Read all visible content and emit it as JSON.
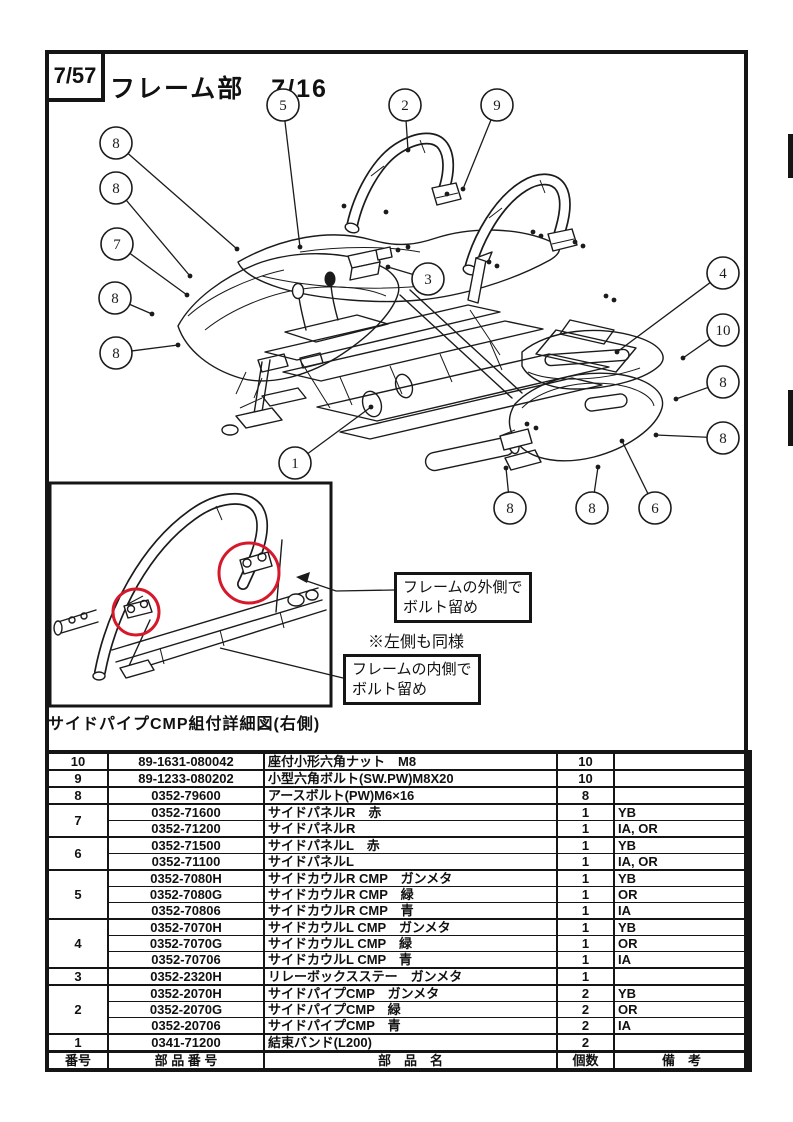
{
  "page": {
    "page_ref": "7/57",
    "title": "フレーム部　7/16"
  },
  "diagram": {
    "inset": {
      "caption": "サイドパイプCMP組付詳細図(右側)",
      "outside_label": [
        "フレームの外側で",
        "ボルト留め"
      ],
      "note": "※左側も同様",
      "inside_label": [
        "フレームの内側で",
        "ボルト留め"
      ],
      "highlight_color": "#d6182b"
    },
    "balloons": [
      {
        "n": "8",
        "x": 116,
        "y": 143,
        "tx": 237,
        "ty": 249
      },
      {
        "n": "8",
        "x": 116,
        "y": 188,
        "tx": 190,
        "ty": 276
      },
      {
        "n": "7",
        "x": 117,
        "y": 244,
        "tx": 187,
        "ty": 295
      },
      {
        "n": "8",
        "x": 115,
        "y": 298,
        "tx": 152,
        "ty": 314
      },
      {
        "n": "8",
        "x": 116,
        "y": 353,
        "tx": 178,
        "ty": 345
      },
      {
        "n": "5",
        "x": 283,
        "y": 105,
        "tx": 300,
        "ty": 247
      },
      {
        "n": "2",
        "x": 405,
        "y": 105,
        "tx": 408,
        "ty": 150
      },
      {
        "n": "9",
        "x": 497,
        "y": 105,
        "tx": 463,
        "ty": 189
      },
      {
        "n": "3",
        "x": 428,
        "y": 279,
        "tx": 388,
        "ty": 267
      },
      {
        "n": "1",
        "x": 295,
        "y": 463,
        "tx": 371,
        "ty": 407
      },
      {
        "n": "4",
        "x": 723,
        "y": 273,
        "tx": 617,
        "ty": 352
      },
      {
        "n": "10",
        "x": 723,
        "y": 330,
        "tx": 683,
        "ty": 358
      },
      {
        "n": "8",
        "x": 723,
        "y": 382,
        "tx": 676,
        "ty": 399
      },
      {
        "n": "8",
        "x": 723,
        "y": 438,
        "tx": 656,
        "ty": 435
      },
      {
        "n": "8",
        "x": 510,
        "y": 508,
        "tx": 506,
        "ty": 468
      },
      {
        "n": "8",
        "x": 592,
        "y": 508,
        "tx": 598,
        "ty": 467
      },
      {
        "n": "6",
        "x": 655,
        "y": 508,
        "tx": 622,
        "ty": 441
      }
    ]
  },
  "table": {
    "header": [
      "番号",
      "部 品 番 号",
      "部　品　名",
      "個数",
      "備　考"
    ],
    "groups": [
      {
        "no": "10",
        "rows": [
          [
            "89-1631-080042",
            "座付小形六角ナット　M8",
            "10",
            ""
          ]
        ]
      },
      {
        "no": "9",
        "rows": [
          [
            "89-1233-080202",
            "小型六角ボルト(SW.PW)M8X20",
            "10",
            ""
          ]
        ]
      },
      {
        "no": "8",
        "rows": [
          [
            "0352-79600",
            "アースボルト(PW)M6×16",
            "8",
            ""
          ]
        ]
      },
      {
        "no": "7",
        "rows": [
          [
            "0352-71600",
            "サイドパネルR　赤",
            "1",
            "YB"
          ],
          [
            "0352-71200",
            "サイドパネルR",
            "1",
            "IA, OR"
          ]
        ]
      },
      {
        "no": "6",
        "rows": [
          [
            "0352-71500",
            "サイドパネルL　赤",
            "1",
            "YB"
          ],
          [
            "0352-71100",
            "サイドパネルL",
            "1",
            "IA, OR"
          ]
        ]
      },
      {
        "no": "5",
        "rows": [
          [
            "0352-7080H",
            "サイドカウルR CMP　ガンメタ",
            "1",
            "YB"
          ],
          [
            "0352-7080G",
            "サイドカウルR CMP　緑",
            "1",
            "OR"
          ],
          [
            "0352-70806",
            "サイドカウルR CMP　青",
            "1",
            "IA"
          ]
        ]
      },
      {
        "no": "4",
        "rows": [
          [
            "0352-7070H",
            "サイドカウルL CMP　ガンメタ",
            "1",
            "YB"
          ],
          [
            "0352-7070G",
            "サイドカウルL CMP　緑",
            "1",
            "OR"
          ],
          [
            "0352-70706",
            "サイドカウルL CMP　青",
            "1",
            "IA"
          ]
        ]
      },
      {
        "no": "3",
        "rows": [
          [
            "0352-2320H",
            "リレーボックスステー　ガンメタ",
            "1",
            ""
          ]
        ]
      },
      {
        "no": "2",
        "rows": [
          [
            "0352-2070H",
            "サイドパイプCMP　ガンメタ",
            "2",
            "YB"
          ],
          [
            "0352-2070G",
            "サイドパイプCMP　緑",
            "2",
            "OR"
          ],
          [
            "0352-20706",
            "サイドパイプCMP　青",
            "2",
            "IA"
          ]
        ]
      },
      {
        "no": "1",
        "rows": [
          [
            "0341-71200",
            "結束バンド(L200)",
            "2",
            ""
          ]
        ]
      }
    ]
  }
}
